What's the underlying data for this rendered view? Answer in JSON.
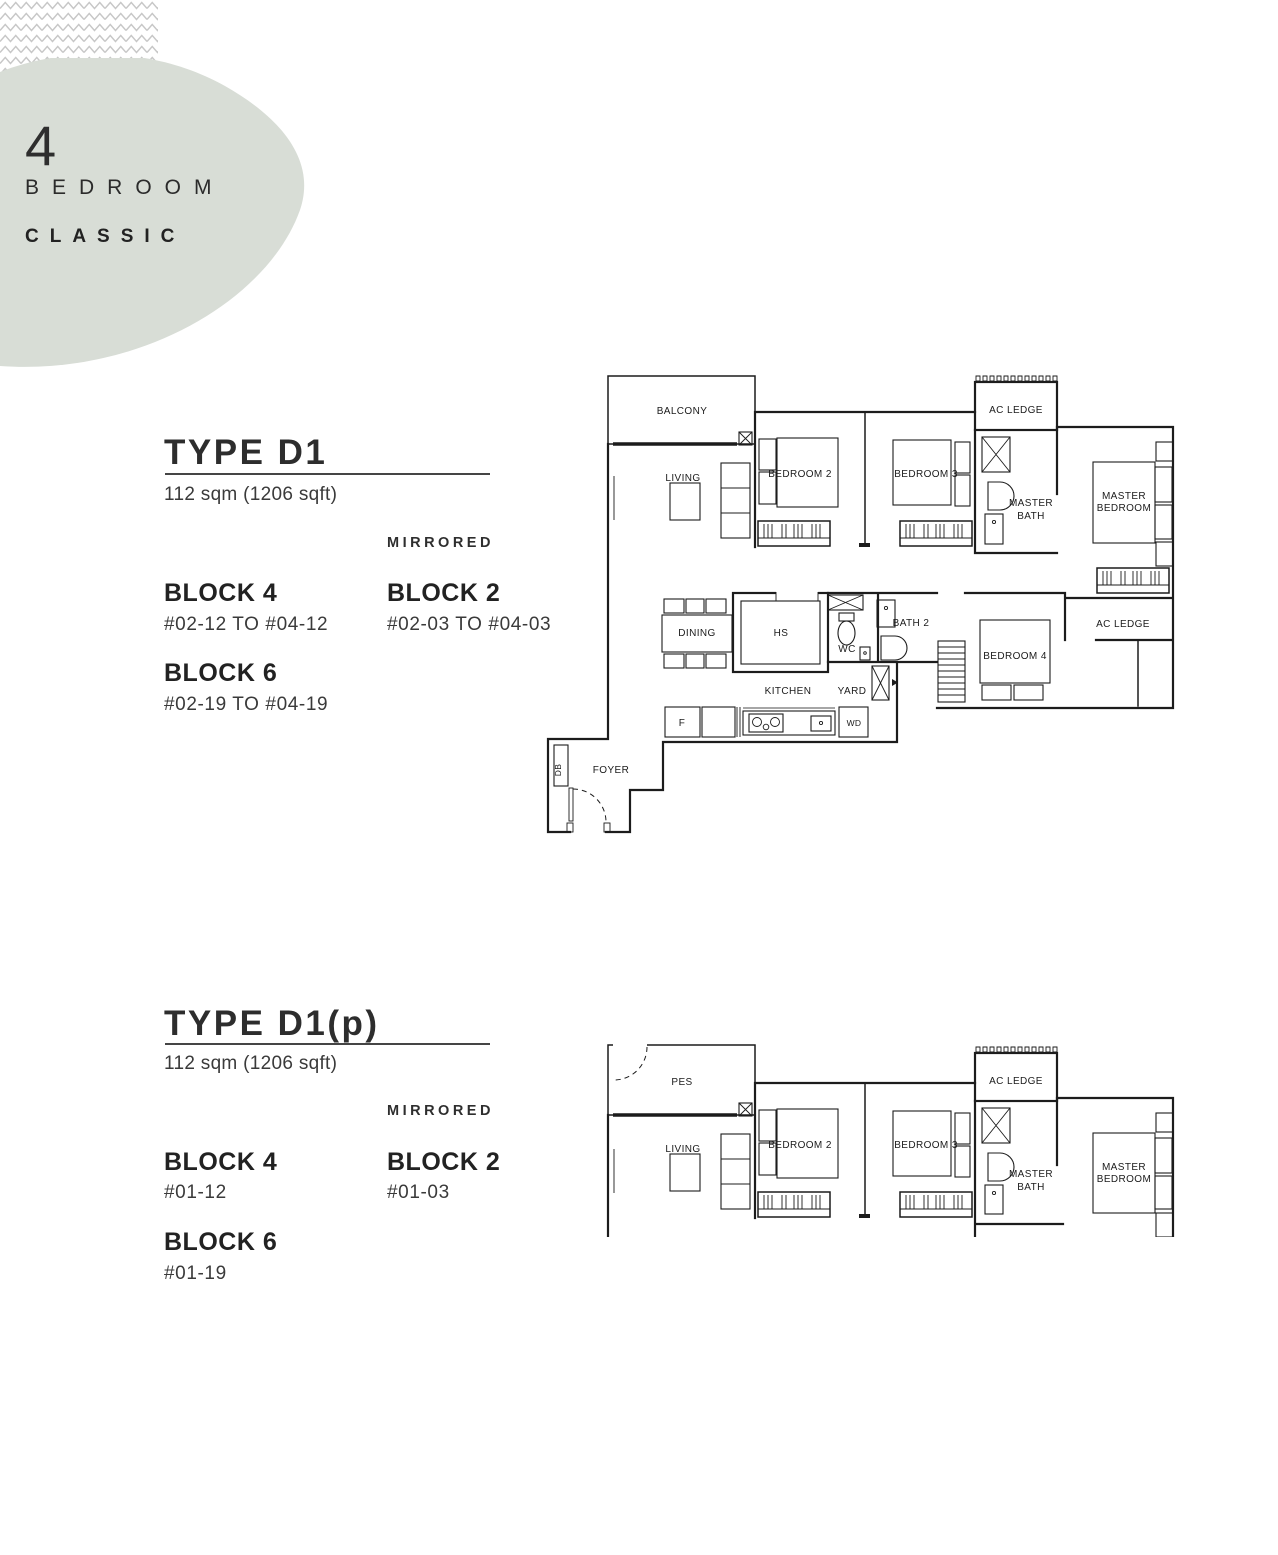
{
  "badge": {
    "number": "4",
    "line1": "BEDROOM",
    "line2": "CLASSIC"
  },
  "sections": [
    {
      "type_title": "TYPE D1",
      "area": "112 sqm (1206 sqft)",
      "mirrored_label": "MIRRORED",
      "blocks": [
        {
          "name": "BLOCK 4",
          "units": "#02-12 TO #04-12"
        },
        {
          "name": "BLOCK 2",
          "units": "#02-03 TO #04-03"
        },
        {
          "name": "BLOCK 6",
          "units": "#02-19 TO #04-19"
        }
      ]
    },
    {
      "type_title": "TYPE D1(p)",
      "area": "112 sqm (1206 sqft)",
      "mirrored_label": "MIRRORED",
      "blocks": [
        {
          "name": "BLOCK 4",
          "units": "#01-12"
        },
        {
          "name": "BLOCK 2",
          "units": "#01-03"
        },
        {
          "name": "BLOCK 6",
          "units": "#01-19"
        }
      ]
    }
  ],
  "plan_labels": {
    "balcony": "BALCONY",
    "pes": "PES",
    "living": "LIVING",
    "bedroom_2": "BEDROOM 2",
    "bedroom_3": "BEDROOM 3",
    "bedroom_4": "BEDROOM 4",
    "master_bedroom_line1": "MASTER",
    "master_bedroom_line2": "BEDROOM",
    "master_bath_line1": "MASTER",
    "master_bath_line2": "BATH",
    "ac_ledge": "AC LEDGE",
    "dining": "DINING",
    "hs": "HS",
    "wc": "WC",
    "bath_2": "BATH 2",
    "kitchen": "KITCHEN",
    "yard": "YARD",
    "fridge": "F",
    "washer_dryer": "WD",
    "db": "DB",
    "foyer": "FOYER"
  },
  "colors": {
    "blob": "#d8ddd6",
    "zigzag": "#c7c7c7",
    "ink": "#2d2d2d",
    "plan_line": "#1c1c1c"
  }
}
